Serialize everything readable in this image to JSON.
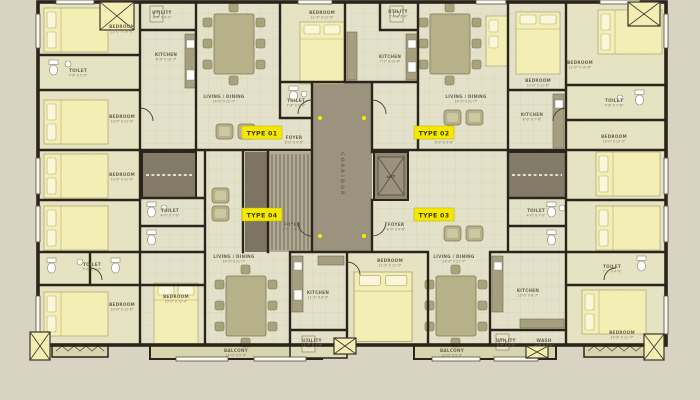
{
  "plan": {
    "type": "apartment-typical-floor-plan"
  },
  "colors": {
    "background": "#d8d3c3",
    "floor": "#e3e1c9",
    "wall": "#2b241b",
    "corridor": "#9c937e",
    "stairs": "#b2aa93",
    "dark_room": "#837b68",
    "bed": "#f3eeb4",
    "furniture": "#b7b189",
    "balcony": "#d8d5ae",
    "badge_yellow": "#f6e800",
    "dot_yellow": "#f6ec00"
  },
  "badges": [
    {
      "label": "TYPE 01"
    },
    {
      "label": "TYPE 02"
    },
    {
      "label": "TYPE 03"
    },
    {
      "label": "TYPE 04"
    }
  ],
  "core": {
    "corridor": "CORRIDOR",
    "lift": "LIFT"
  },
  "rooms": [
    {
      "name": "BEDROOM",
      "dims": "12'-0\" X 10'-6\""
    },
    {
      "name": "TOILET",
      "dims": "7'-6\" X 5'-0\""
    },
    {
      "name": "BEDROOM",
      "dims": "13'-0\" X 11'-0\""
    },
    {
      "name": "KITCHEN",
      "dims": "8'-0\" X 10'-7\""
    },
    {
      "name": "UTILITY",
      "dims": "8'-0\" X 4'-0\""
    },
    {
      "name": "LIVING / DINING",
      "dims": "14'-0\" X 21'-7\""
    },
    {
      "name": "FOYER",
      "dims": "6'-0\" X 4'-6\""
    },
    {
      "name": "BEDROOM",
      "dims": "11'-3\" X 12'-0\""
    },
    {
      "name": "TOILET",
      "dims": "7'-4\" X 5'-0\""
    },
    {
      "name": "KITCHEN",
      "dims": "7'-0\" X 10'-6\""
    },
    {
      "name": "UTILITY",
      "dims": "7'-0\" X 3'-6\""
    },
    {
      "name": "FOYER",
      "dims": "6'-0\" X 4'-6\""
    },
    {
      "name": "LIVING / DINING",
      "dims": "14'-0\" X 21'-7\""
    },
    {
      "name": "KITCHEN",
      "dims": "8'-0\" X 7'-6\""
    },
    {
      "name": "BEDROOM",
      "dims": "10'-0\" X 11'-6\""
    },
    {
      "name": "BEDROOM",
      "dims": "12'-0\" X 10'-6\""
    },
    {
      "name": "TOILET",
      "dims": "5'-6\" X 7'-6\""
    },
    {
      "name": "BEDROOM",
      "dims": "10'-0\" X 12'-0\""
    },
    {
      "name": "TOILET",
      "dims": "4'-0\" X 7'-0\""
    },
    {
      "name": "BEDROOM",
      "dims": "10'-0\" X 12'-0\""
    },
    {
      "name": "TOILET",
      "dims": "4'-0\" X 7'-0\""
    },
    {
      "name": "TOILET",
      "dims": "7'-0\" X 5'-0\""
    },
    {
      "name": "BEDROOM",
      "dims": "10'-0\" X 12'-6\""
    },
    {
      "name": "BEDROOM",
      "dims": "10'-0\" X 12'-0\""
    },
    {
      "name": "LIVING / DINING",
      "dims": "14'-0\" X 21'-7\""
    },
    {
      "name": "FOYER",
      "dims": "6'-0\" X 4'-6\""
    },
    {
      "name": "KITCHEN",
      "dims": "11'-2\" X 8'-0\""
    },
    {
      "name": "UTILITY",
      "dims": "11'-2\" X 3'-6\""
    },
    {
      "name": "BEDROOM",
      "dims": "11'-0\" X 12'-0\""
    },
    {
      "name": "FOYER",
      "dims": "6'-0\" X 4'-6\""
    },
    {
      "name": "LIVING / DINING",
      "dims": "14'-0\" X 21'-7\""
    },
    {
      "name": "KITCHEN",
      "dims": "10'-0\" X 8'-7\""
    },
    {
      "name": "UTILITY",
      "dims": "5'-0\" X 4'-0\""
    },
    {
      "name": "WASH",
      "dims": "3'-6\" X 4'-0\""
    },
    {
      "name": "BEDROOM",
      "dims": "10'-6\" X 11'-7\""
    },
    {
      "name": "TOILET",
      "dims": "7'-2\" X 4'-0\""
    },
    {
      "name": "BALCONY",
      "dims": "14'-0\" X 5'-0\""
    },
    {
      "name": "BALCONY",
      "dims": "10'-0\" X 5'-0\""
    }
  ]
}
